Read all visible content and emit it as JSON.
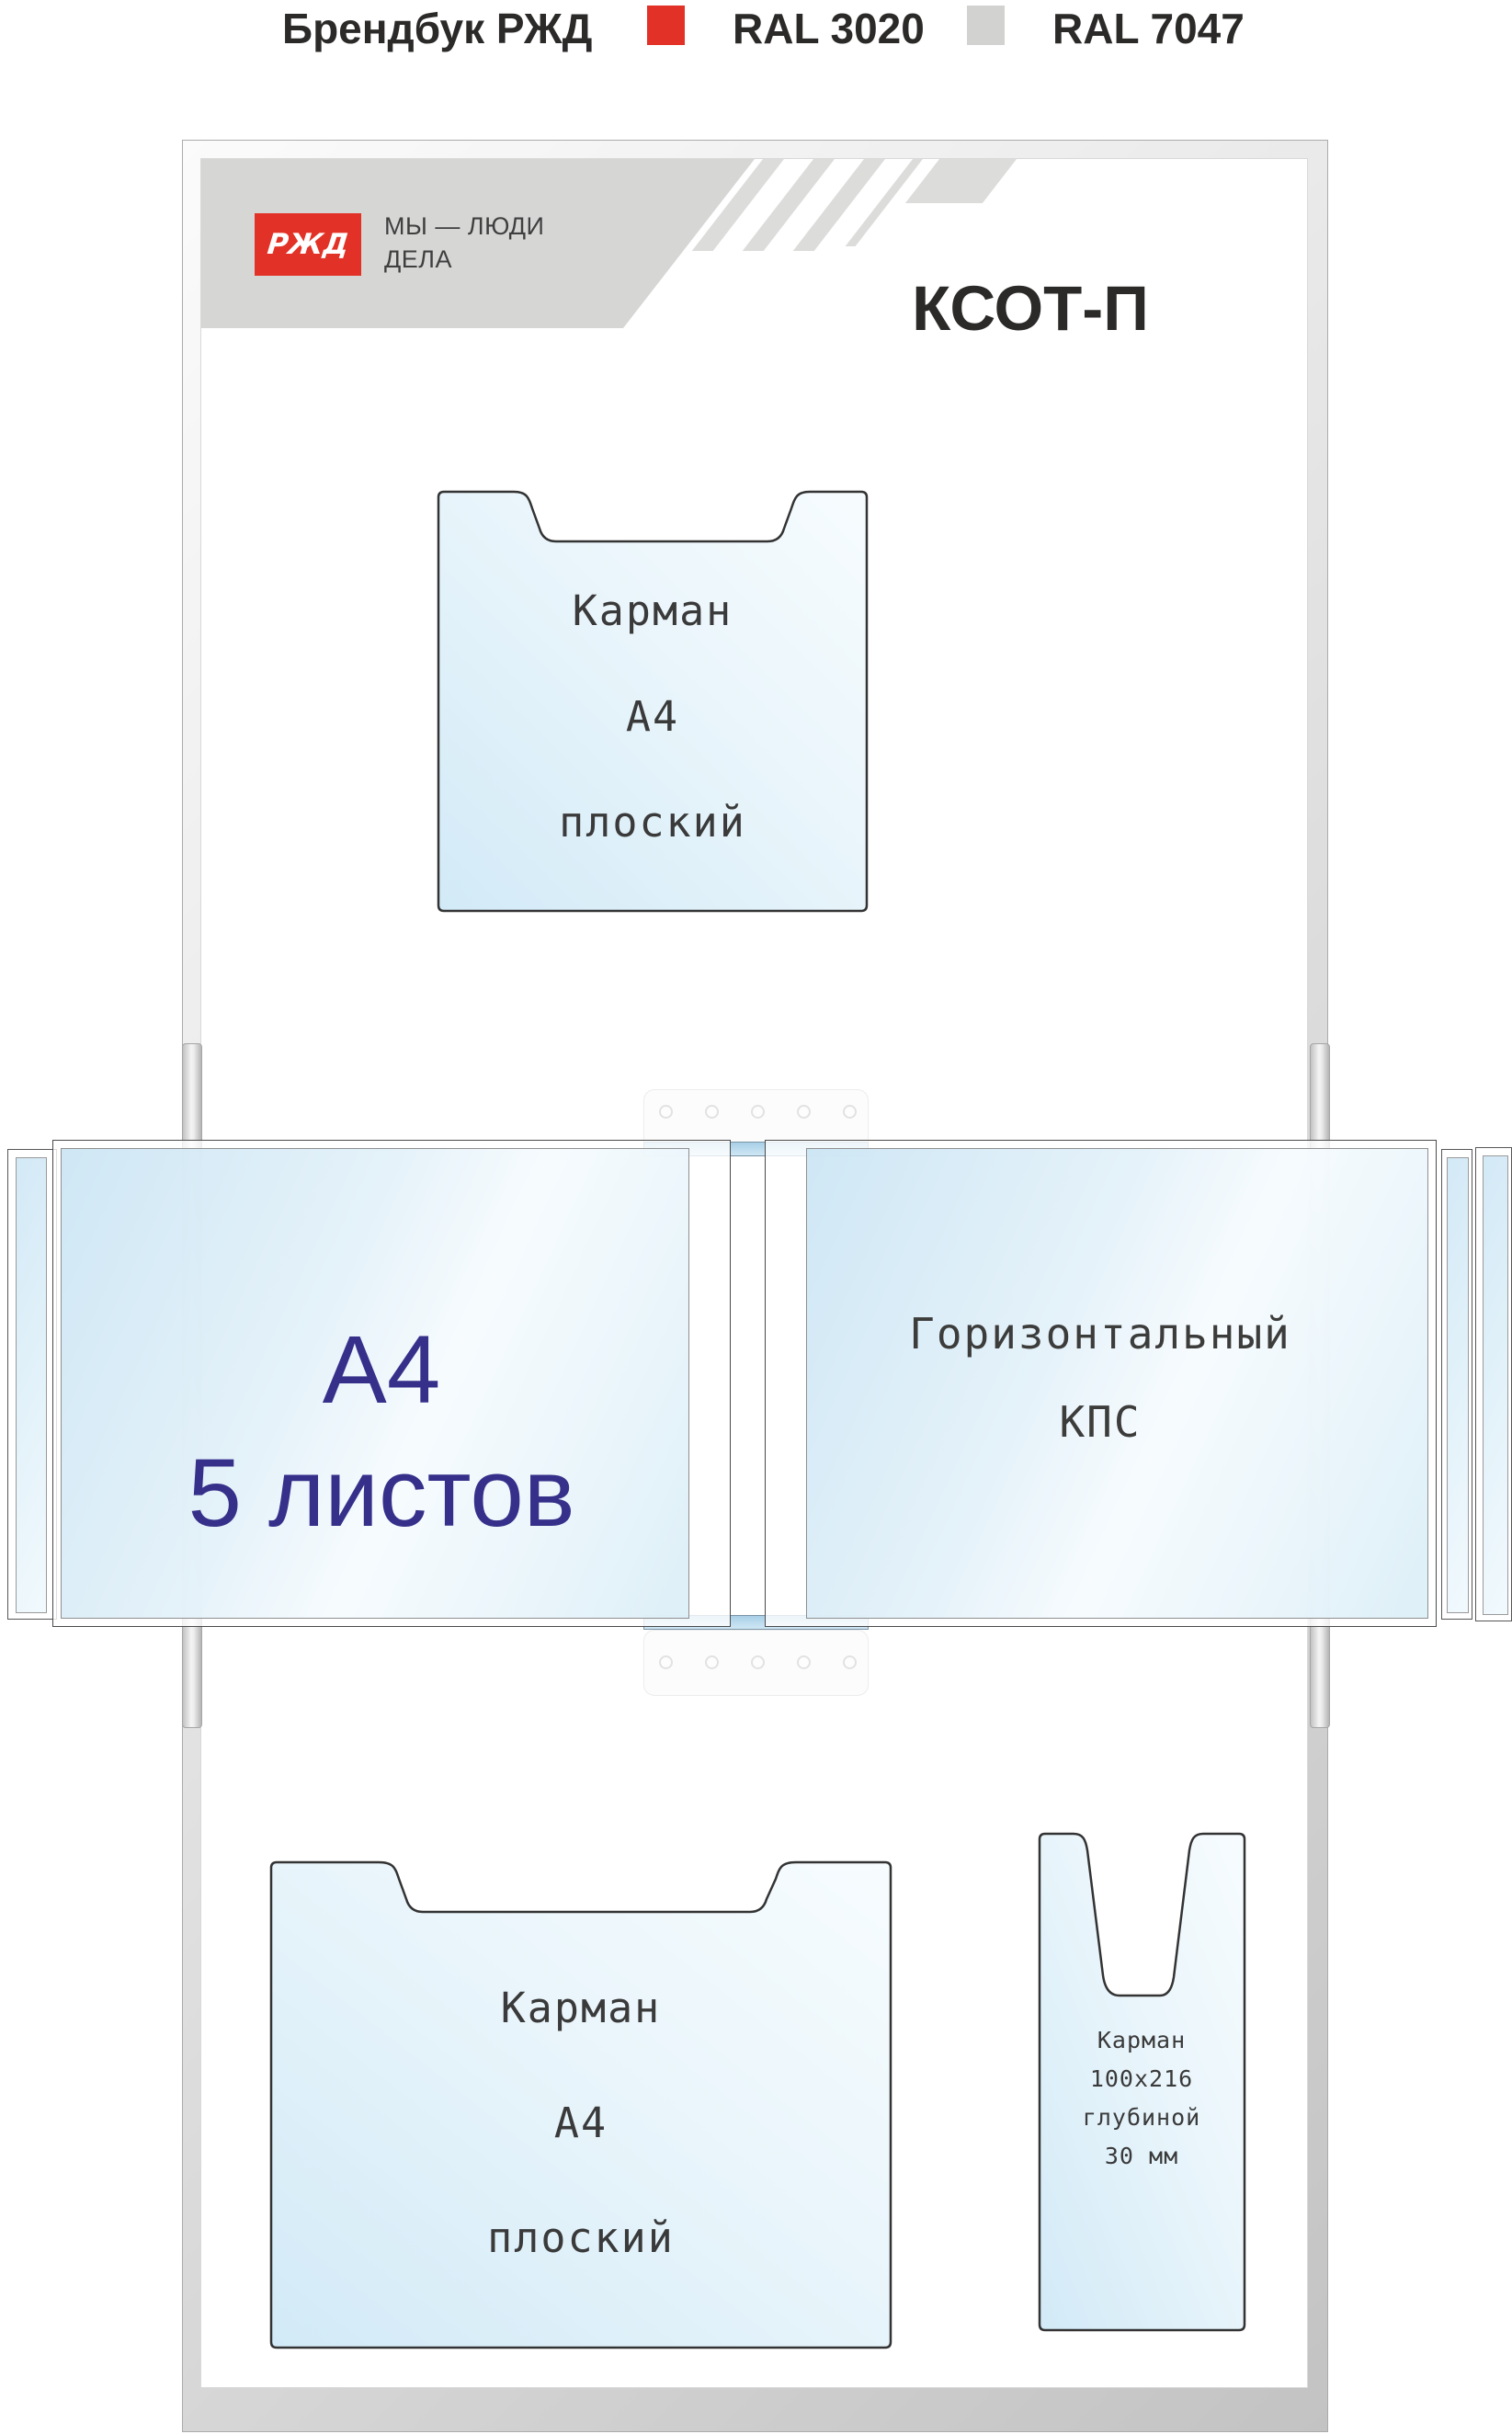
{
  "header": {
    "title": "Брендбук РЖД",
    "swatches": [
      {
        "label": "RAL 3020",
        "color": "#e23227"
      },
      {
        "label": "RAL 7047",
        "color": "#d2d3d1"
      }
    ]
  },
  "board": {
    "logo_text": "РЖД",
    "slogan_line1": "МЫ — ЛЮДИ",
    "slogan_line2": "ДЕЛА",
    "title": "КСОТ-П"
  },
  "flip_section": {
    "left_panel": {
      "line1": "А4",
      "line2": "5 листов"
    },
    "right_panel": {
      "line1": "Горизонтальный",
      "line2": "КПС"
    }
  },
  "pockets": {
    "top_a4": {
      "lines": [
        "Карман",
        "А4",
        "плоский"
      ]
    },
    "bottom_a4": {
      "lines": [
        "Карман",
        "А4",
        "плоский"
      ]
    },
    "narrow": {
      "lines": [
        "Карман",
        "100x216",
        "глубиной",
        "30 мм"
      ]
    }
  },
  "colors": {
    "ral3020": "#e23227",
    "ral7047": "#d2d3d1",
    "band_gray": "#d6d7d5",
    "panel_blue": "#cde6f4",
    "navy_text": "#36308a"
  }
}
